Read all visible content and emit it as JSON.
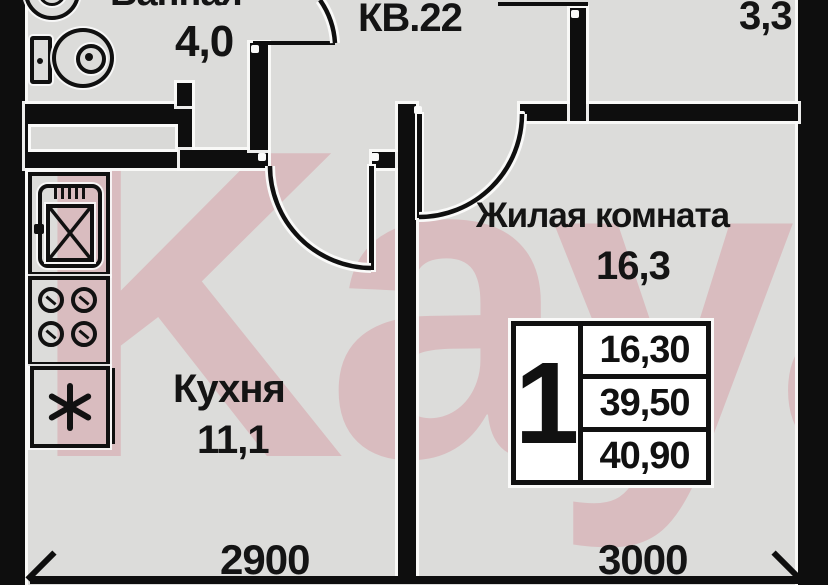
{
  "watermark": {
    "text": "Kayan"
  },
  "apartment": {
    "label": "КВ.22",
    "rooms": {
      "bathroom": {
        "name": "Ванная",
        "area": "4,0"
      },
      "kitchen": {
        "name": "Кухня",
        "area": "11,1"
      },
      "living": {
        "name": "Жилая комната",
        "area": "16,3"
      },
      "balcony": {
        "area": "3,3"
      }
    }
  },
  "summary_table": {
    "rooms_count": "1",
    "rows": [
      "16,30",
      "39,50",
      "40,90"
    ]
  },
  "dimensions": {
    "bottom_left": "2900",
    "bottom_right": "3000"
  },
  "icons": {
    "bathroom": [
      "toilet-icon",
      "sink-icon"
    ],
    "kitchen": [
      "kitchen-sink-icon",
      "stove-icon",
      "fridge-icon"
    ]
  },
  "colors": {
    "floor": "#dcdcda",
    "wall": "#0e0e0e",
    "watermark_pink": "#d27887",
    "table_bg": "#ffffff",
    "text": "#141414"
  }
}
